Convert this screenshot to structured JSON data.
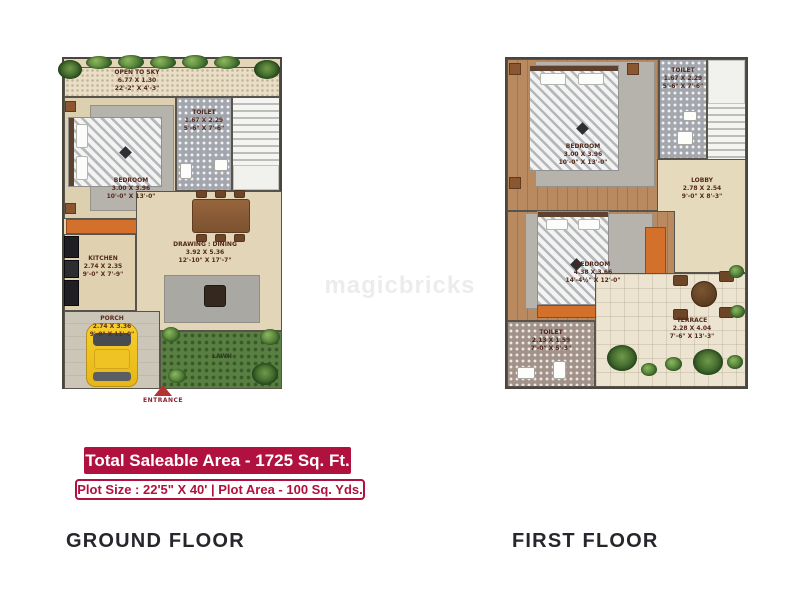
{
  "colors": {
    "accent": "#b0113f",
    "room_label_text": "#53281c",
    "title_text": "#26262c",
    "lawn_green": "#5a7f42",
    "wood_brown": "#b9895f",
    "car_yellow": "#f6ce2d"
  },
  "watermark": "magicbricks",
  "summary": {
    "total_area": "Total Saleable Area - 1725 Sq. Ft.",
    "plot_info": "Plot Size : 22'5\" X 40' | Plot Area - 100 Sq. Yds."
  },
  "ground_floor": {
    "title": "GROUND FLOOR",
    "entrance_label": "ENTRANCE",
    "rooms": {
      "open_to_sky": {
        "name": "OPEN TO SKY",
        "dim_m": "6.77 X 1.30",
        "dim_ft": "22'-2\" X 4'-3\""
      },
      "bedroom": {
        "name": "BEDROOM",
        "dim_m": "3.00 X 3.96",
        "dim_ft": "10'-0\" X 13'-0\""
      },
      "toilet": {
        "name": "TOILET",
        "dim_m": "1.67 X 2.29",
        "dim_ft": "5'-6\" X 7'-6\""
      },
      "kitchen": {
        "name": "KITCHEN",
        "dim_m": "2.74 X 2.35",
        "dim_ft": "9'-0\" X 7'-9\""
      },
      "drawing_dining": {
        "name": "DRAWING : DINING",
        "dim_m": "3.92 X 5.36",
        "dim_ft": "12'-10\" X 17'-7\""
      },
      "porch": {
        "name": "PORCH",
        "dim_m": "2.74 X 3.36",
        "dim_ft": "9'-0\" X 11'-0\""
      },
      "lawn": {
        "name": "LAWN"
      }
    }
  },
  "first_floor": {
    "title": "FIRST FLOOR",
    "rooms": {
      "bedroom1": {
        "name": "BEDROOM",
        "dim_m": "3.00 X 3.96",
        "dim_ft": "10'-0\" X 13'-0\""
      },
      "toilet1": {
        "name": "TOILET",
        "dim_m": "1.67 X 2.29",
        "dim_ft": "5'-6\" X 7'-6\""
      },
      "lobby": {
        "name": "LOBBY",
        "dim_m": "2.78 X 2.54",
        "dim_ft": "9'-0\" X 8'-3\""
      },
      "bedroom2": {
        "name": "BEDROOM",
        "dim_m": "4.38 X 3.66",
        "dim_ft": "14'-4½\" X 12'-0\""
      },
      "toilet2": {
        "name": "TOILET",
        "dim_m": "2.13 X 1.59",
        "dim_ft": "7'-0\" X 5'-3\""
      },
      "terrace": {
        "name": "TERRACE",
        "dim_m": "2.28 X 4.04",
        "dim_ft": "7'-6\" X 13'-3\""
      }
    }
  }
}
